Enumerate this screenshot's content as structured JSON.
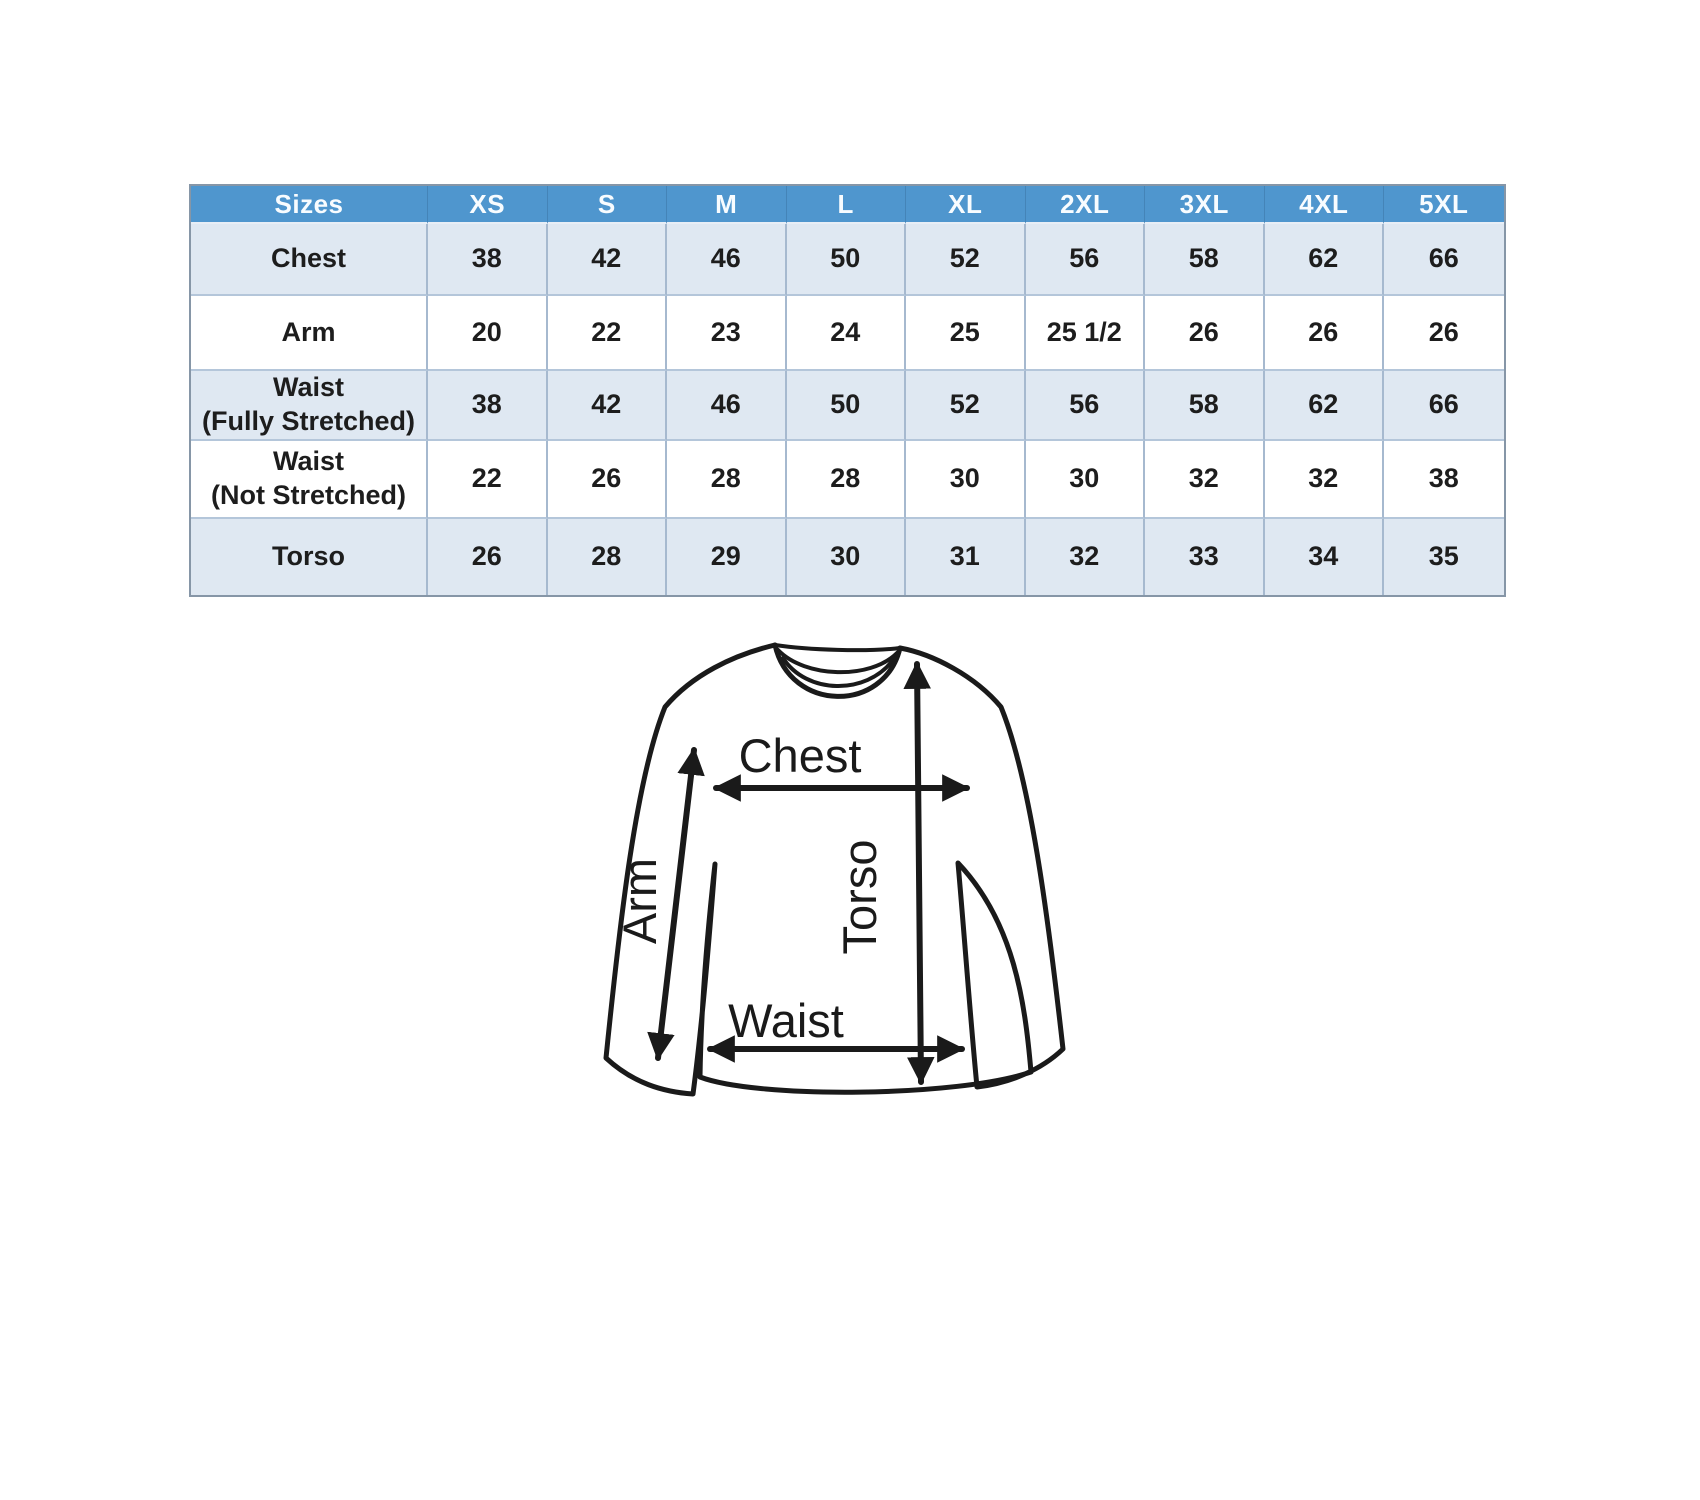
{
  "chart_data": {
    "type": "table",
    "columns": [
      "Sizes",
      "XS",
      "S",
      "M",
      "L",
      "XL",
      "2XL",
      "3XL",
      "4XL",
      "5XL"
    ],
    "rows": [
      {
        "label": "Chest",
        "values": [
          "38",
          "42",
          "46",
          "50",
          "52",
          "56",
          "58",
          "62",
          "66"
        ]
      },
      {
        "label": "Arm",
        "values": [
          "20",
          "22",
          "23",
          "24",
          "25",
          "25 1/2",
          "26",
          "26",
          "26"
        ]
      },
      {
        "label": "Waist",
        "label_note": "(Fully Stretched)",
        "values": [
          "38",
          "42",
          "46",
          "50",
          "52",
          "56",
          "58",
          "62",
          "66"
        ]
      },
      {
        "label": "Waist",
        "label_note": "(Not Stretched)",
        "values": [
          "22",
          "26",
          "28",
          "28",
          "30",
          "30",
          "32",
          "32",
          "38"
        ]
      },
      {
        "label": "Torso",
        "values": [
          "26",
          "28",
          "29",
          "30",
          "31",
          "32",
          "33",
          "34",
          "35"
        ]
      }
    ]
  },
  "diagram": {
    "labels": {
      "chest": "Chest",
      "arm": "Arm",
      "torso": "Torso",
      "waist": "Waist"
    }
  },
  "colors": {
    "header_bg": "#4f96ce",
    "header_text": "#f8fcff",
    "band_row_bg": "#dfe8f2",
    "white_row_bg": "#ffffff",
    "grid_line": "#a6b9cf",
    "row_line": "#b4c6da",
    "outer_border": "#8696a7",
    "cell_text": "#1d1d1d",
    "line_art": "#1a1a1a"
  }
}
